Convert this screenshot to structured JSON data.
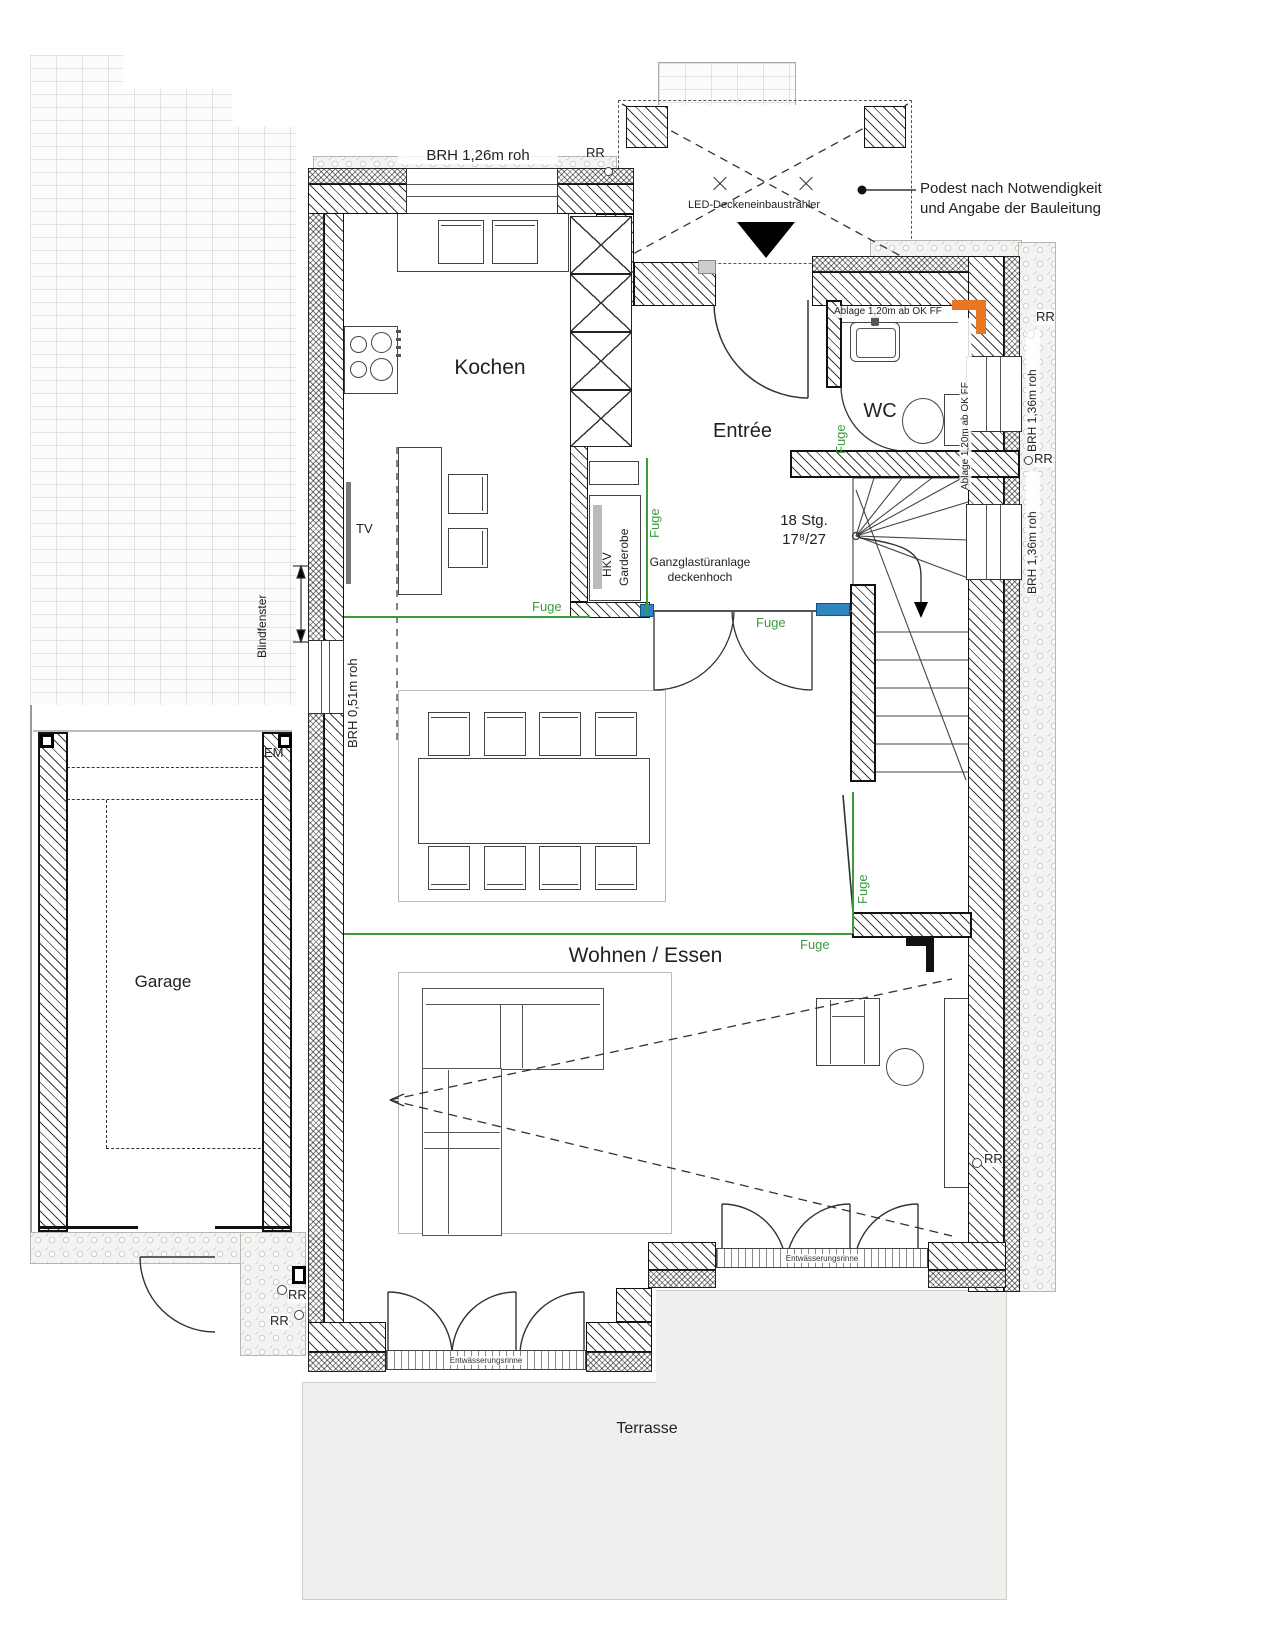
{
  "site": {
    "podest_note_line1": "Podest nach Notwendigkeit",
    "podest_note_line2": "und Angabe der Bauleitung",
    "led_label": "LED-Deckeneinbaustrahler",
    "rr": "RR",
    "em": "EM",
    "garage": "Garage",
    "terrasse": "Terrasse"
  },
  "rooms": {
    "kitchen": "Kochen",
    "entree": "Entrée",
    "wc": "WC",
    "living": "Wohnen / Essen"
  },
  "windows": {
    "top": "BRH 1,26m roh",
    "left": "BRH 0,51m roh",
    "right": "BRH 1,36m roh",
    "blind": "Blindfenster"
  },
  "stairs": {
    "line1": "18 Stg.",
    "line2": "17⁸/27"
  },
  "labels": {
    "fuge": "Fuge",
    "ablage": "Ablage 1,20m ab OK FF",
    "glass_door_line1": "Ganzglastüranlage",
    "glass_door_line2": "deckenhoch",
    "garderobe": "Garderobe",
    "hkv": "HKV",
    "tv": "TV",
    "drain": "Entwässerungsrinne"
  },
  "colors": {
    "fuge_green": "#3d9b3d",
    "glass_blue": "#2e86c1",
    "vent_orange": "#e87722"
  }
}
